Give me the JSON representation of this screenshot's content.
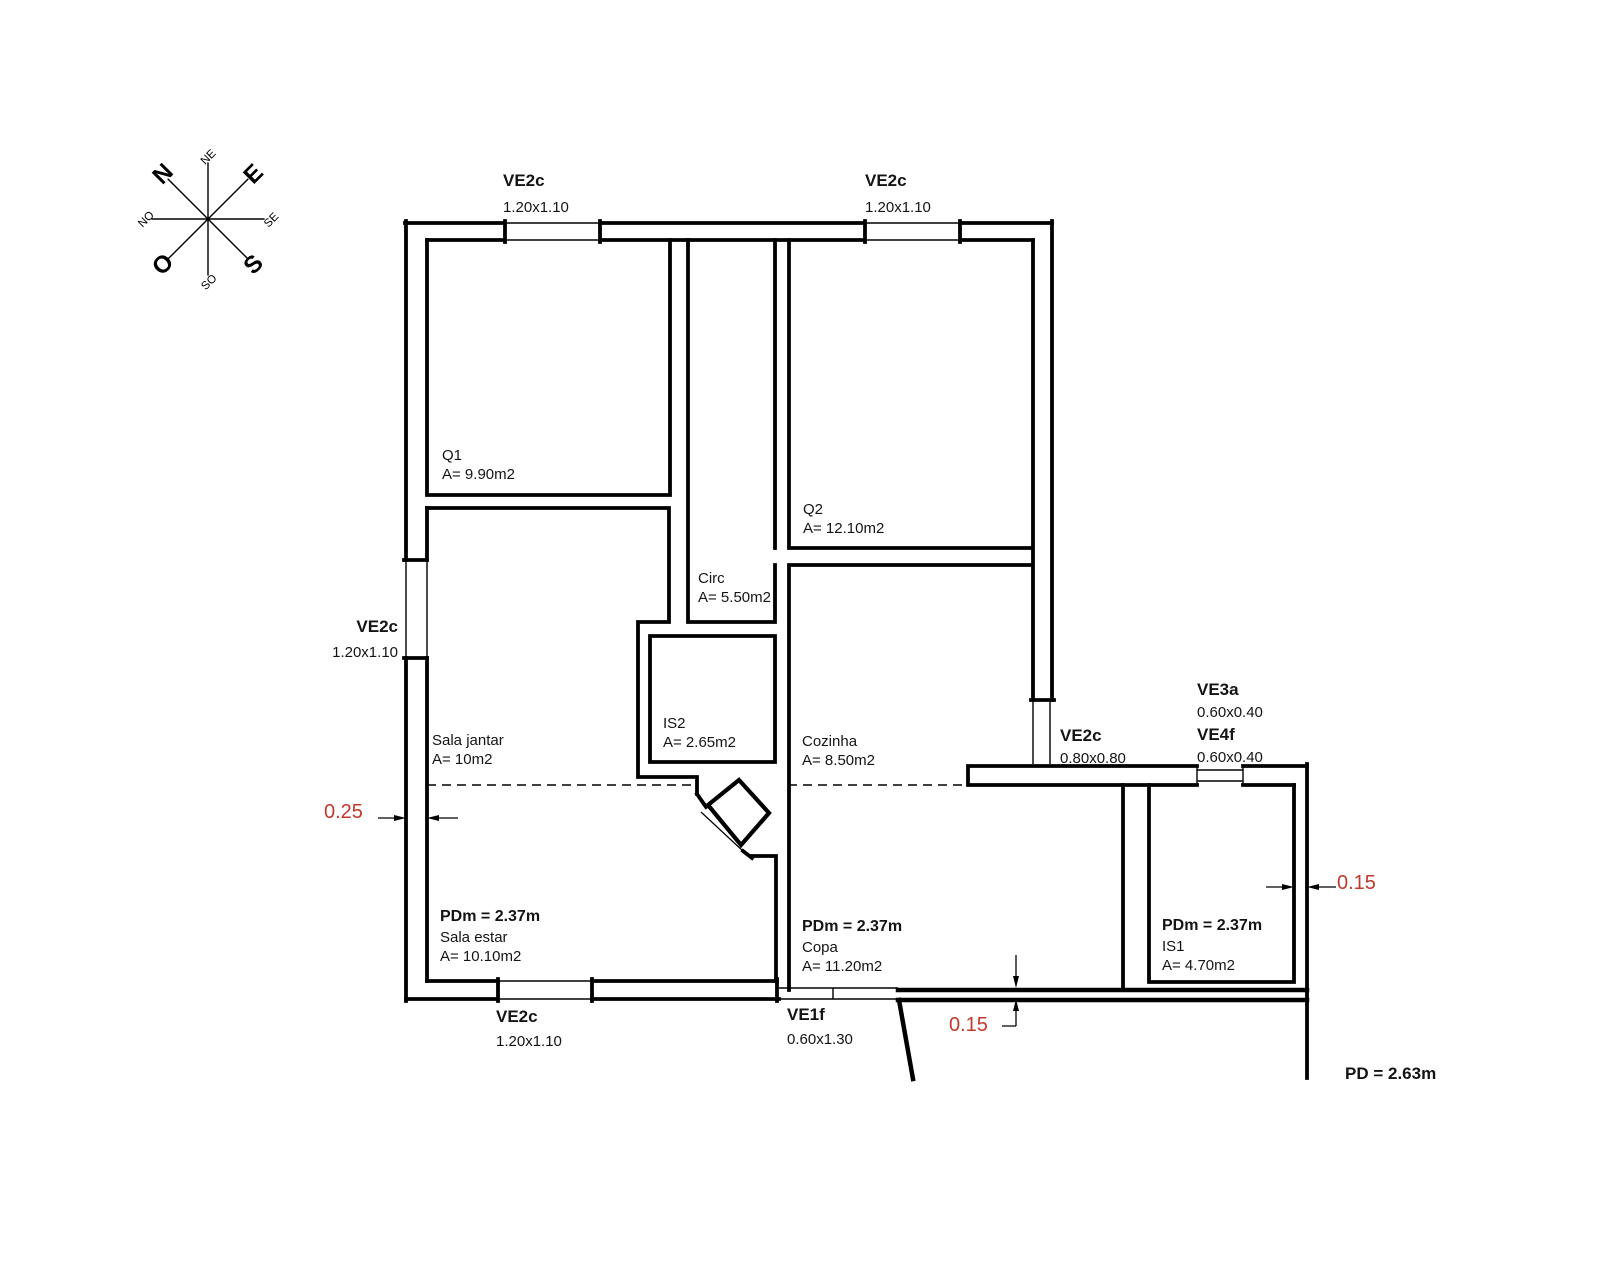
{
  "compass": {
    "n": "N",
    "ne": "NE",
    "e": "E",
    "se": "SE",
    "s": "S",
    "so": "SO",
    "o": "O",
    "no": "NO"
  },
  "colors": {
    "wall": "#000000",
    "dim_text": "#c0392b"
  },
  "windows": {
    "top_left": {
      "name": "VE2c",
      "size": "1.20x1.10"
    },
    "top_right": {
      "name": "VE2c",
      "size": "1.20x1.10"
    },
    "left": {
      "name": "VE2c",
      "size": "1.20x1.10"
    },
    "bottom": {
      "name": "VE2c",
      "size": "1.20x1.10"
    },
    "ve1f": {
      "name": "VE1f",
      "size": "0.60x1.30"
    },
    "ve2c_east": {
      "name": "VE2c",
      "size": "0.80x0.80"
    },
    "ve3a": {
      "name": "VE3a",
      "size": "0.60x0.40"
    },
    "ve4f": {
      "name": "VE4f",
      "size": "0.60x0.40"
    }
  },
  "rooms": {
    "q1": {
      "name": "Q1",
      "area": "A= 9.90m2"
    },
    "q2": {
      "name": "Q2",
      "area": "A= 12.10m2"
    },
    "circ": {
      "name": "Circ",
      "area": "A= 5.50m2"
    },
    "is2": {
      "name": "IS2",
      "area": "A= 2.65m2"
    },
    "cozinha": {
      "name": "Cozinha",
      "area": "A= 8.50m2"
    },
    "sala_jantar": {
      "name": "Sala jantar",
      "area": "A= 10m2"
    },
    "sala_estar": {
      "height": "PDm = 2.37m",
      "name": "Sala estar",
      "area": "A= 10.10m2"
    },
    "copa": {
      "height": "PDm = 2.37m",
      "name": "Copa",
      "area": "A= 11.20m2"
    },
    "is1": {
      "height": "PDm = 2.37m",
      "name": "IS1",
      "area": "A= 4.70m2"
    }
  },
  "dimensions": {
    "wall_left": "0.25",
    "wall_bottom": "0.15",
    "wall_right": "0.15"
  },
  "ceiling": {
    "pd": "PD = 2.63m"
  }
}
